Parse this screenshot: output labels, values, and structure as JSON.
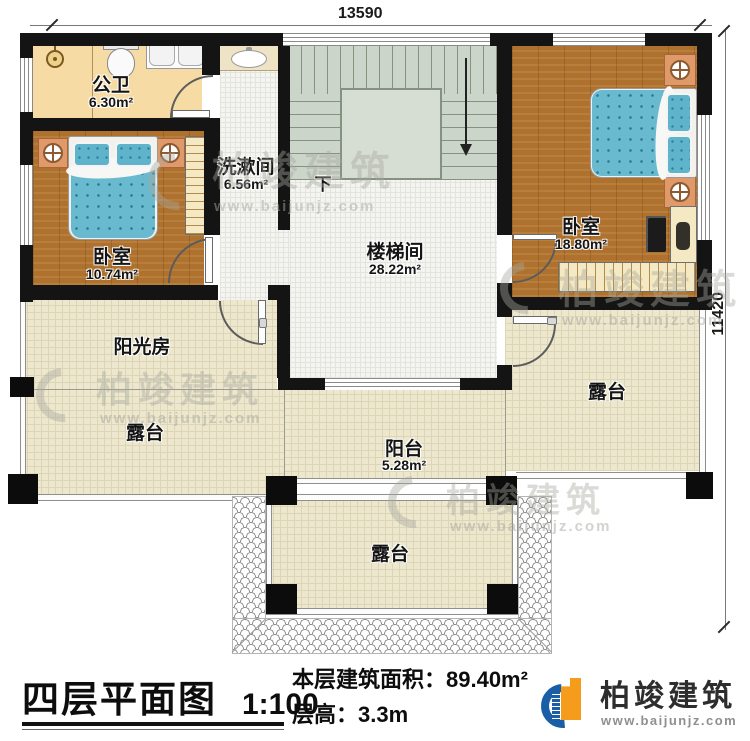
{
  "palette": {
    "wall": "#141414",
    "wood_floor": "#af722e",
    "tile_checker_light": "#f6dca4",
    "tile_checker_dark": "#d9a05f",
    "hall_floor": "#f4f5f1",
    "terrace_floor": "#ece7cd",
    "stairs_floor": "#ccd5ca",
    "bed_blue": "#69bacf",
    "nightstand_orange": "#e09a6a",
    "brand_blue": "#1a5ea8",
    "brand_orange": "#f69c1c"
  },
  "dimensions": {
    "top": "13590",
    "right": "11420"
  },
  "rooms": {
    "bathroom": {
      "name": "公卫",
      "area": "6.30m²"
    },
    "washroom": {
      "name": "洗漱间",
      "area": "6.56m²"
    },
    "bedroom_left": {
      "name": "卧室",
      "area": "10.74m²"
    },
    "bedroom_right": {
      "name": "卧室",
      "area": "18.80m²"
    },
    "stairwell": {
      "name": "楼梯间",
      "area": "28.22m²"
    },
    "sunroom": {
      "name": "阳光房"
    },
    "terrace": {
      "name": "露台"
    },
    "balcony": {
      "name": "阳台",
      "area": "5.28m²"
    }
  },
  "stairs": {
    "down_label": "下"
  },
  "title_block": {
    "title": "四层平面图",
    "scale": "1:100",
    "floor_area": "本层建筑面积：89.40m²",
    "floor_height": "层高：3.3m"
  },
  "brand": {
    "name": "柏竣建筑",
    "website": "www.baijunjz.com"
  },
  "watermark": {
    "name": "柏竣建筑",
    "website": "www.baijunjz.com"
  }
}
